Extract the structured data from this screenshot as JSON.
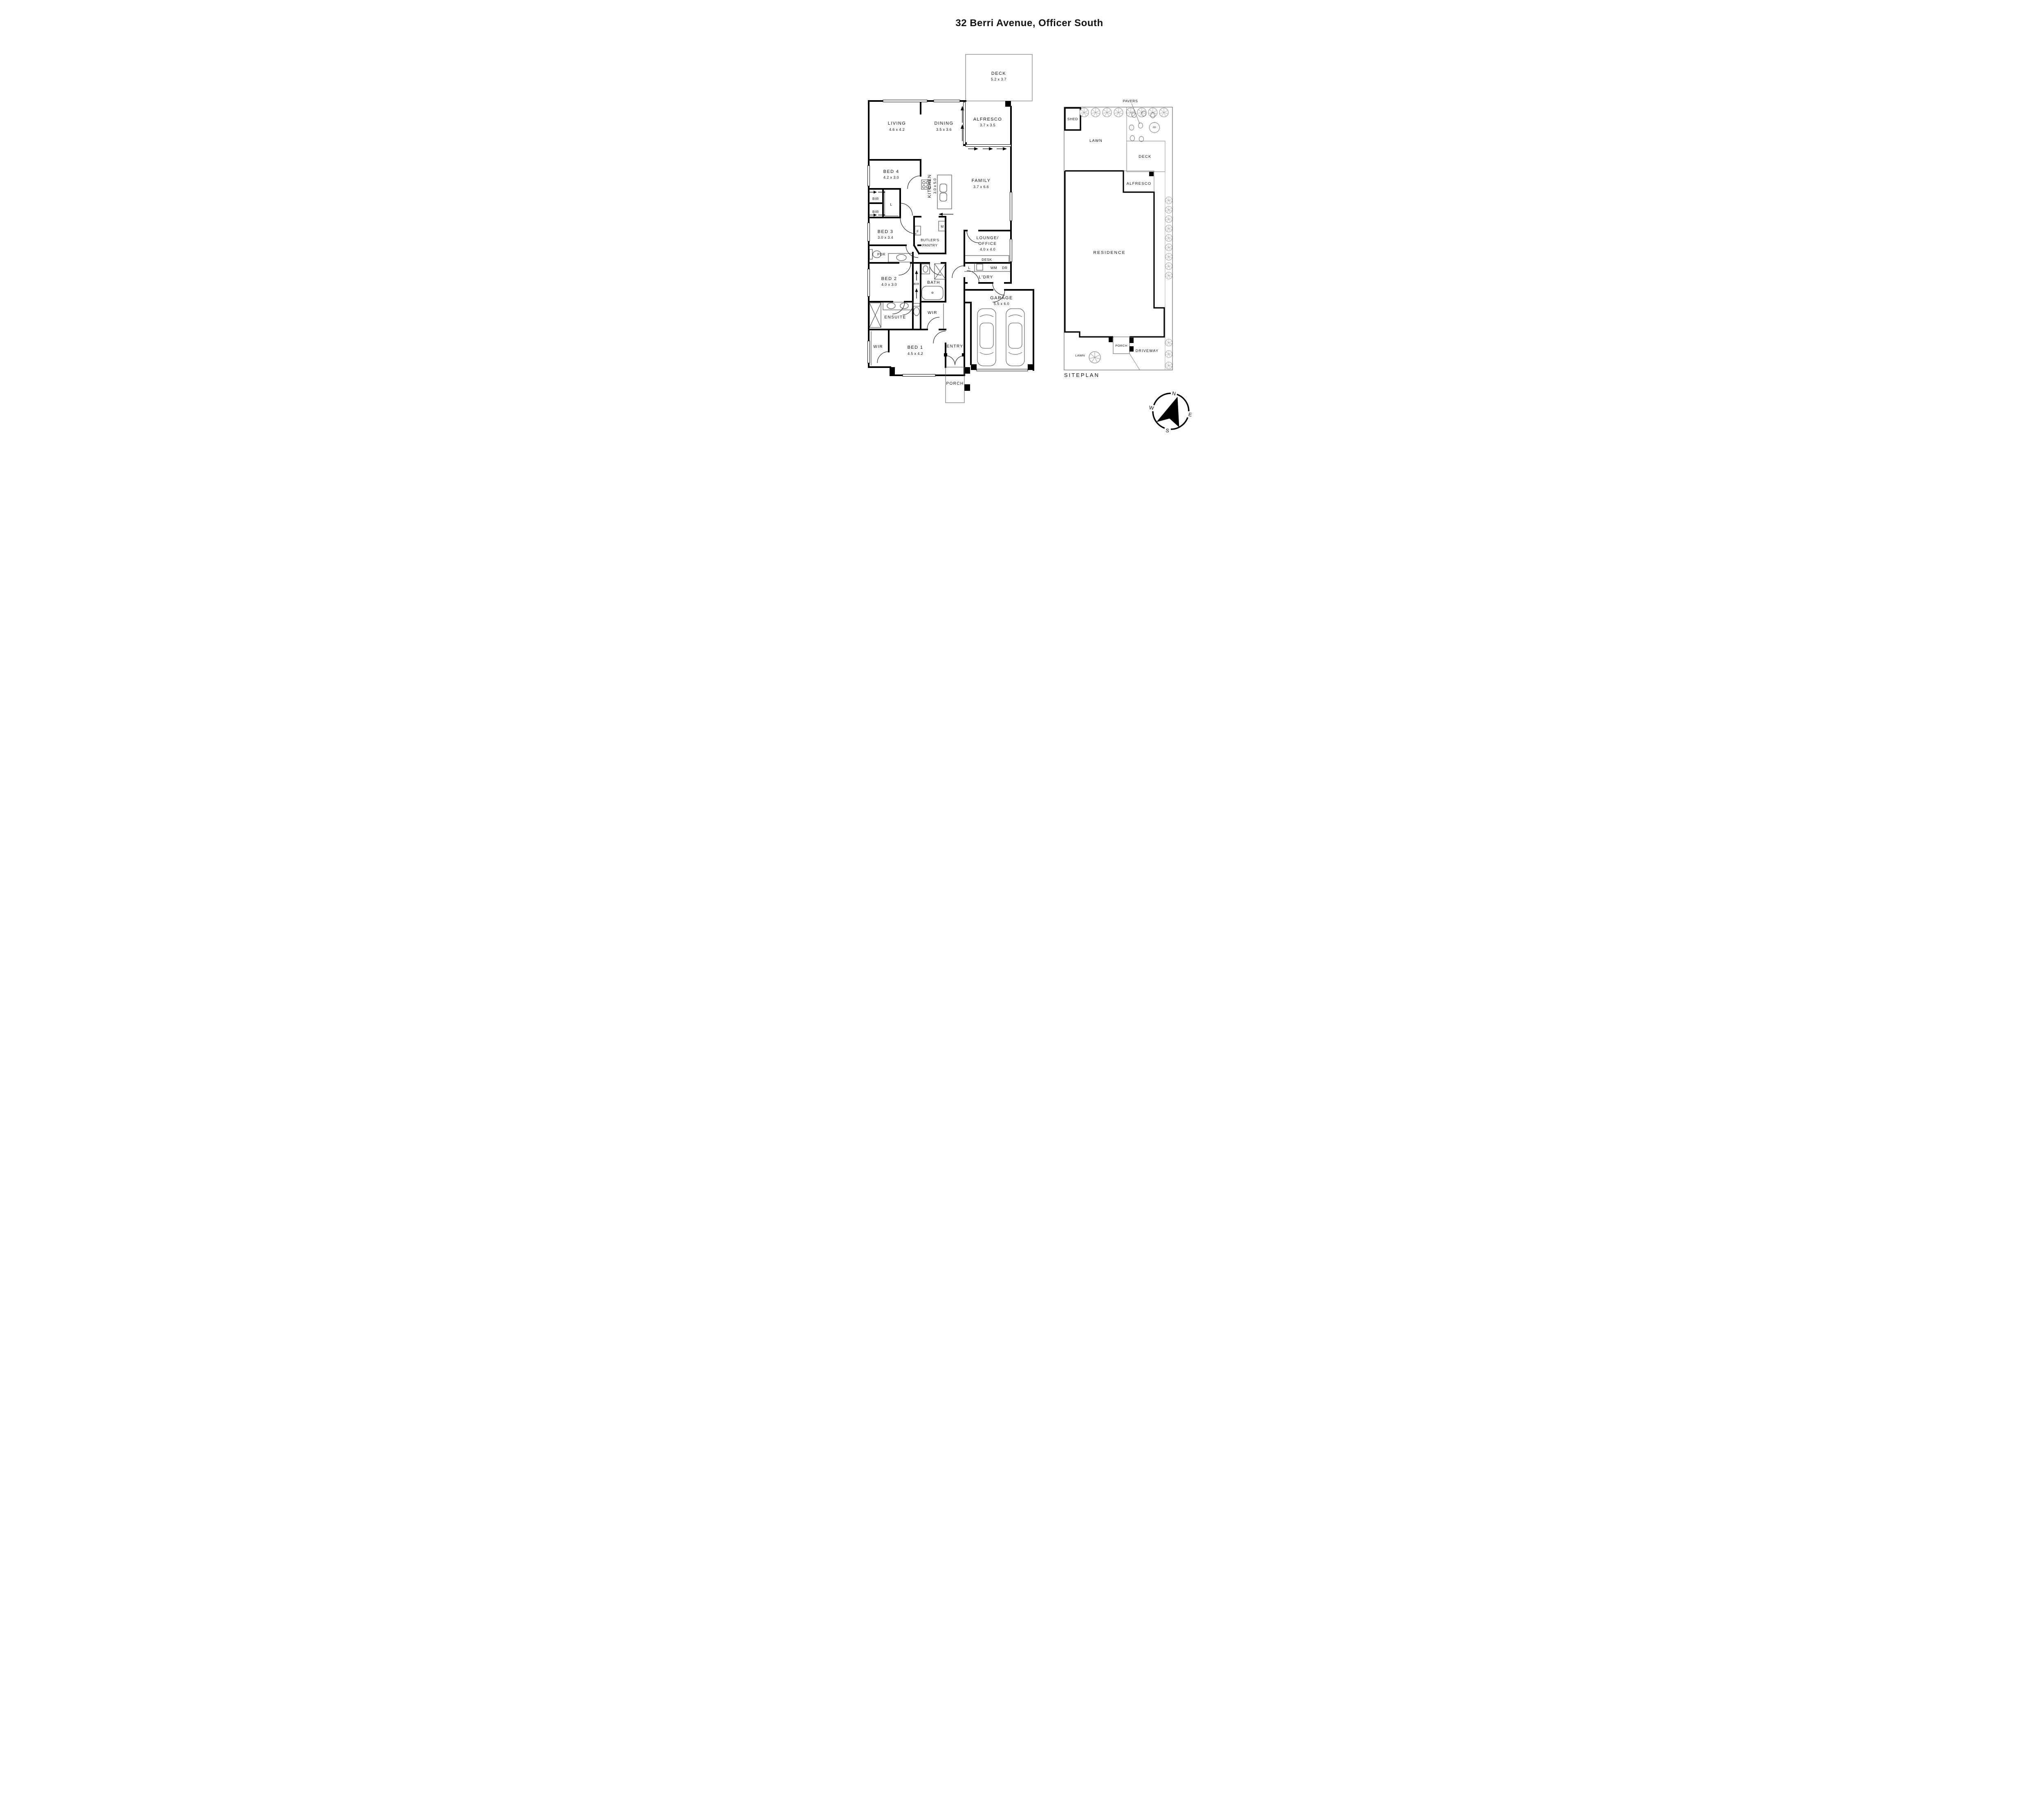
{
  "title": "32 Berri Avenue, Officer South",
  "floorplan": {
    "deck": {
      "name": "DECK",
      "dims": "5.2 x 3.7"
    },
    "alfresco": {
      "name": "ALFRESCO",
      "dims": "3.7 x 3.5"
    },
    "living": {
      "name": "LIVING",
      "dims": "4.6 x 4.2"
    },
    "dining": {
      "name": "DINING",
      "dims": "3.5 x 3.6"
    },
    "family": {
      "name": "FAMILY",
      "dims": "3.7 x 6.6"
    },
    "kitchen": {
      "name": "KITCHEN",
      "dims": "3.0 x 5.0"
    },
    "bed4": {
      "name": "BED 4",
      "dims": "4.2 x 3.0"
    },
    "bed3": {
      "name": "BED 3",
      "dims": "3.0 x 3.4"
    },
    "bed2": {
      "name": "BED 2",
      "dims": "4.0 x 3.0"
    },
    "bed1": {
      "name": "BED 1",
      "dims": "4.5 x 4.2"
    },
    "garage": {
      "name": "GARAGE",
      "dims": "5.5 x 6.0"
    },
    "lounge": {
      "line1": "LOUNGE/",
      "line2": "OFFICE",
      "dims": "4.0 x 4.0"
    },
    "butlers_pantry": {
      "line1": "BUTLER'S",
      "line2": "PANTRY"
    },
    "pdr": "PDR",
    "bath": "BATH",
    "ensuite": "ENSUITE",
    "wir_ensuite": "WIR",
    "wir_bed1": "WIR",
    "entry": "ENTRY",
    "porch": "PORCH",
    "ldry": "L'DRY",
    "desk": "DESK",
    "bir": "BIR",
    "appliances": {
      "fridge": "F",
      "microwave": "M",
      "linen": "L",
      "laundry_linen": "L",
      "washing_machine": "WM",
      "dryer": "DR"
    }
  },
  "siteplan": {
    "shed": "SHED",
    "pavers": "PAVERS",
    "lawn_rear": "LAWN",
    "deck": "DECK",
    "alfresco": "ALFRESCO",
    "residence": "RESIDENCE",
    "porch": "PORCH",
    "lawn_front": "LAWN",
    "driveway": "DRIVEWAY",
    "fire_pit": "FP",
    "caption": "SITEPLAN"
  },
  "compass": {
    "n": "N",
    "e": "E",
    "s": "S",
    "w": "W"
  },
  "colors": {
    "wall": "#000000",
    "thin_line": "#555555",
    "tree": "#777777"
  }
}
